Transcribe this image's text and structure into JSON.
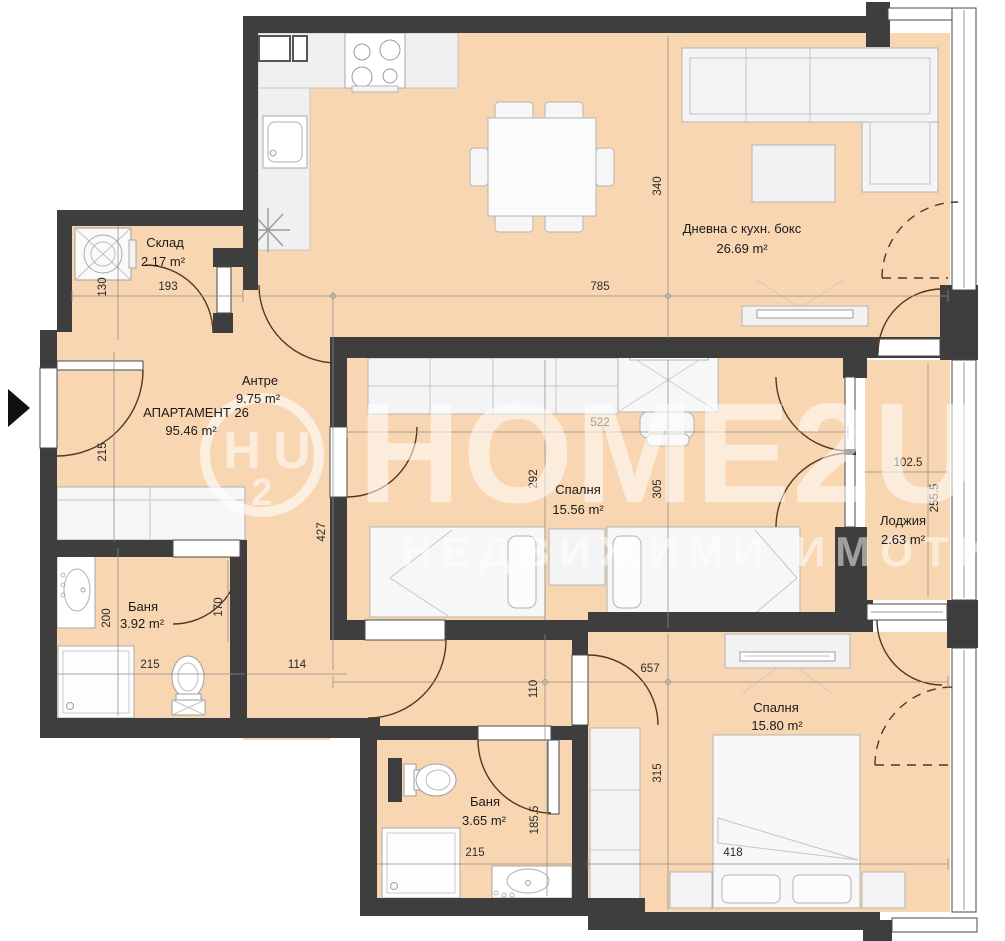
{
  "plan": {
    "apartment": {
      "name": "АПАРТАМЕНТ 26",
      "area": "95.46 m²"
    },
    "rooms": {
      "storage": {
        "name": "Склад",
        "area": "2.17 m²"
      },
      "living": {
        "name": "Дневна с кухн. бокс",
        "area": "26.69 m²"
      },
      "hall": {
        "name": "Антре",
        "area": "9.75 m²"
      },
      "bedroom1": {
        "name": "Спалня",
        "area": "15.56 m²"
      },
      "loggia": {
        "name": "Лоджия",
        "area": "2.63 m²"
      },
      "bath1": {
        "name": "Баня",
        "area": "3.92 m²"
      },
      "bedroom2": {
        "name": "Спалня",
        "area": "15.80 m²"
      },
      "bath2": {
        "name": "Баня",
        "area": "3.65 m²"
      }
    },
    "dimensions": {
      "d130": "130",
      "d193": "193",
      "d785": "785",
      "d340": "340",
      "d215_entry": "215",
      "d427": "427",
      "d292": "292",
      "d522": "522",
      "d305": "305",
      "d102_5": "102.5",
      "d255_5": "255.5",
      "d200": "200",
      "d170": "170",
      "d215_bath1": "215",
      "d114": "114",
      "d657": "657",
      "d110": "110",
      "d315": "315",
      "d418": "418",
      "d215_bath2": "215",
      "d185_5": "185.5"
    },
    "watermark": {
      "brand": "HOME2U",
      "logo_h": "H",
      "logo_2": "2",
      "logo_u": "U",
      "tagline": "НЕДВИЖИМИ ИМОТИ"
    },
    "colors": {
      "floor": "#f9d6b2",
      "wall": "#3e3e3e",
      "furniture": "#f2f2f2",
      "door_arc": "#53381f"
    }
  }
}
